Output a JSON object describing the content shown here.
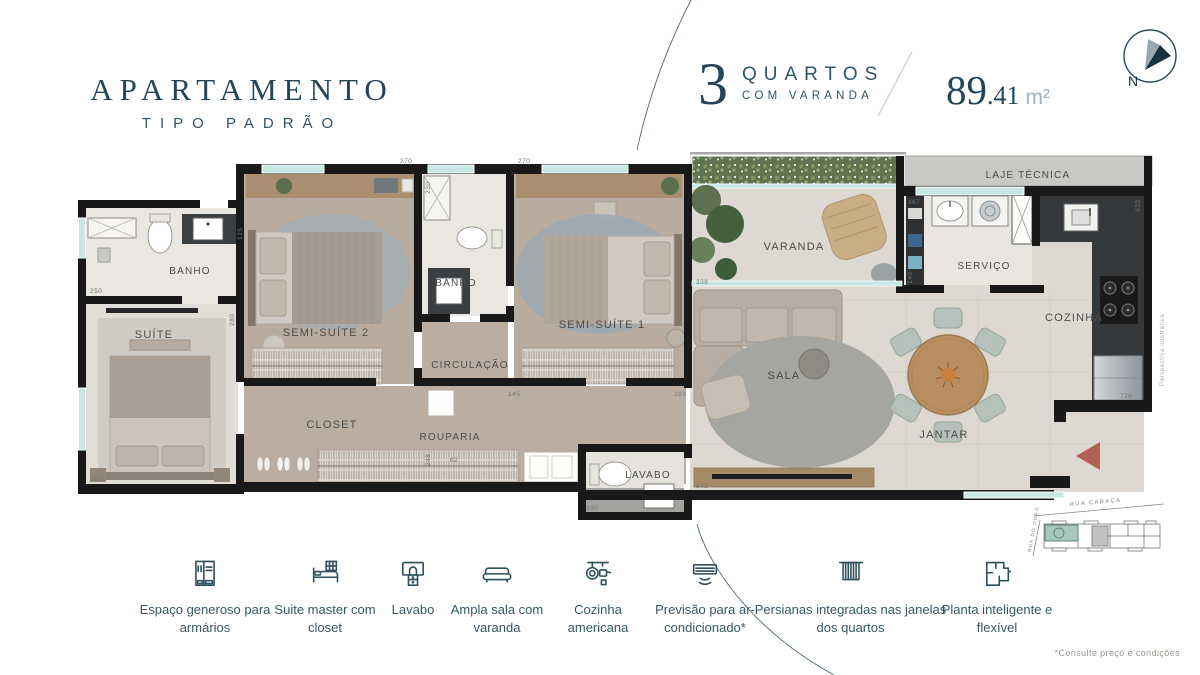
{
  "header": {
    "title": "APARTAMENTO",
    "subtitle": "TIPO PADRÃO",
    "units": {
      "number": "3",
      "label": "QUARTOS",
      "sublabel": "COM VARANDA"
    },
    "area": {
      "value": "89.41",
      "value_main": "89",
      "value_frac": ".41",
      "unit": "m²"
    },
    "compass_n": "N"
  },
  "plan": {
    "rooms": {
      "banho1": "BANHO",
      "suite": "SUÍTE",
      "semi_suite_2": "SEMI-SUÍTE 2",
      "banho2": "BANHO",
      "semi_suite_1": "SEMI-SUÍTE 1",
      "circulacao": "CIRCULAÇÃO",
      "closet": "CLOSET",
      "rouparia": "ROUPARIA",
      "lavabo": "LAVABO",
      "varanda": "VARANDA",
      "sala": "SALA",
      "servico": "SERVIÇO",
      "cozinha": "COZINHA",
      "jantar": "JANTAR",
      "laje": "LAJE TÉCNICA"
    },
    "dims": [
      "270",
      "230",
      "270",
      "125",
      "250",
      "280",
      "563",
      "338",
      "145",
      "248",
      "150",
      "283",
      "367",
      "140",
      "333",
      "726",
      "842",
      "62"
    ],
    "watermark": "Perspectiva ilustrativa"
  },
  "features": [
    {
      "icon": "wardrobe-icon",
      "label": "Espaço generoso para armários"
    },
    {
      "icon": "bed-closet-icon",
      "label": "Suite master com closet"
    },
    {
      "icon": "vanity-icon",
      "label": "Lavabo"
    },
    {
      "icon": "sofa-icon",
      "label": "Ampla sala com varanda"
    },
    {
      "icon": "kitchen-icon",
      "label": "Cozinha americana"
    },
    {
      "icon": "ac-icon",
      "label": "Previsão para ar-condicionado*"
    },
    {
      "icon": "blinds-icon",
      "label": "Persianas integradas nas janelas dos quartos"
    },
    {
      "icon": "floorplan-icon",
      "label": "Planta inteligente e flexível"
    }
  ],
  "keyplan": {
    "street_top": "RUA CARAÇA",
    "street_left": "RUA DO OURO"
  },
  "footnote": "*Consulte preço e condições",
  "colors": {
    "accent": "#24465a",
    "wall": "#191919",
    "window_glass": "#c7e7e4",
    "entry_arrow": "#b2604f",
    "keyplan_highlight": "#a9c7be",
    "wood_floor": "#b9ab9d",
    "tile_floor": "#eae7e2",
    "counter_dark": "#35393c"
  }
}
